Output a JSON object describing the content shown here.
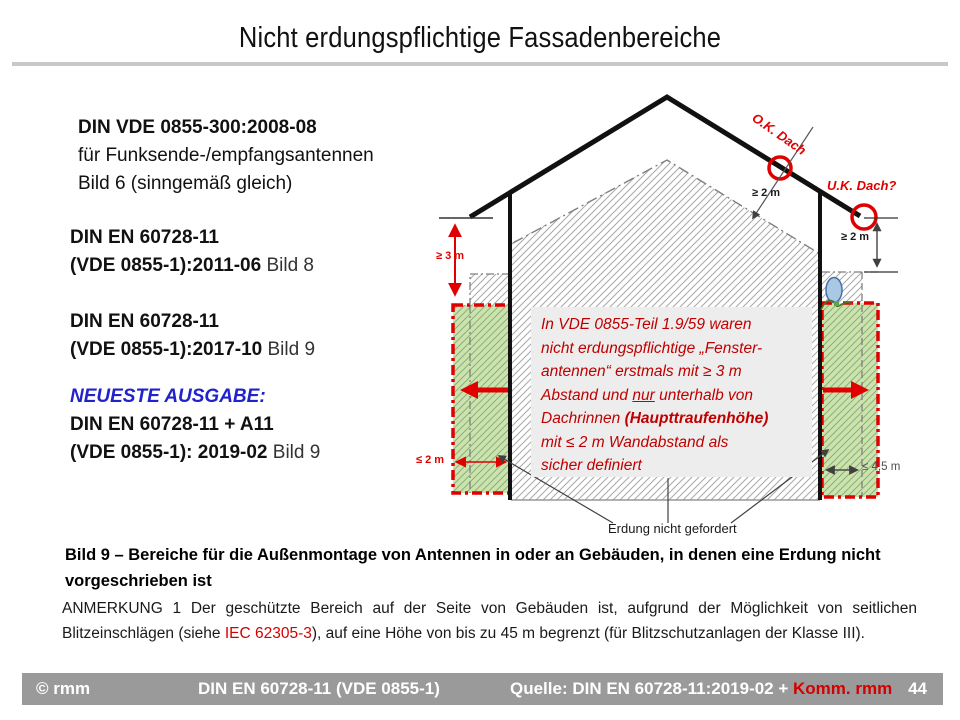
{
  "slide": {
    "title": "Nicht erdungspflichtige Fassadenbereiche",
    "page_number": "44"
  },
  "standards": {
    "vde0855_300": {
      "title": "DIN VDE 0855-300:2008-08",
      "line2": "für Funksende-/empfangsantennen",
      "line3": "Bild 6 (sinngemäß gleich)"
    },
    "en60728_2011": {
      "title": "DIN EN 60728-11",
      "version": "(VDE 0855-1):2011-06",
      "figure": "Bild 8"
    },
    "en60728_2017": {
      "title": "DIN EN 60728-11",
      "version": "(VDE 0855-1):2017-10",
      "figure": "Bild 9"
    },
    "latest": {
      "heading": "NEUESTE AUSGABE:",
      "title": "DIN EN 60728-11 + A11",
      "version": "(VDE 0855-1): 2019-02",
      "figure": "Bild 9"
    }
  },
  "diagram": {
    "labels": {
      "ok_dach": "O.K. Dach",
      "uk_dach": "U.K. Dach?",
      "ge2m_roof": "≥ 2 m",
      "ge2m_wall": "≥ 2 m",
      "ge3m": "≥ 3 m",
      "le2m": "≤ 2 m",
      "le45m": "≤ 4,5 m",
      "erdung": "Erdung nicht gefordert"
    },
    "note_box": {
      "line1": "In VDE 0855-Teil 1.9/59 waren",
      "line2": "nicht erdungspflichtige „Fenster-",
      "line3": "antennen“ erstmals mit ≥ 3 m",
      "line4_a": "Abstand und ",
      "line4_b": "nur",
      "line4_c": " unterhalb von",
      "line5_a": "Dachrinnen ",
      "line5_b": "(Haupttraufenhöhe)",
      "line6": "mit ≤ 2 m Wandabstand als",
      "line7": "sicher definiert"
    }
  },
  "caption": {
    "line1": "Bild 9 – Bereiche für die Außenmontage von Antennen in oder an Gebäuden, in denen eine Erdung nicht",
    "line2": "vorgeschrieben ist"
  },
  "anmerkung": {
    "part1": "ANMERKUNG 1  Der geschützte Bereich auf der Seite von Gebäuden ist, aufgrund der Möglichkeit von seitlichen Blitzeinschlägen (siehe ",
    "iec": "IEC 62305-3",
    "part2": "), auf eine Höhe von bis zu 45 m begrenzt (für Blitzschutzanlagen der Klasse III)."
  },
  "footer": {
    "copyright": "© rmm",
    "center": "DIN EN 60728-11 (VDE 0855-1)",
    "source_prefix": "Quelle: DIN EN 60728-11:2019-02 + ",
    "source_red": "Komm. rmm",
    "page": "44"
  },
  "colors": {
    "diagram_red": "#e00000",
    "note_text_red": "#c00000",
    "heading_blue": "#2222cc",
    "green_zone": "#cbe3ae",
    "hatch_gray": "#a8a8a8",
    "note_box_bg": "#ededed",
    "footer_bg": "#9a9a9a",
    "footer_red": "#d40000",
    "title_rule": "#c8c8c8"
  }
}
